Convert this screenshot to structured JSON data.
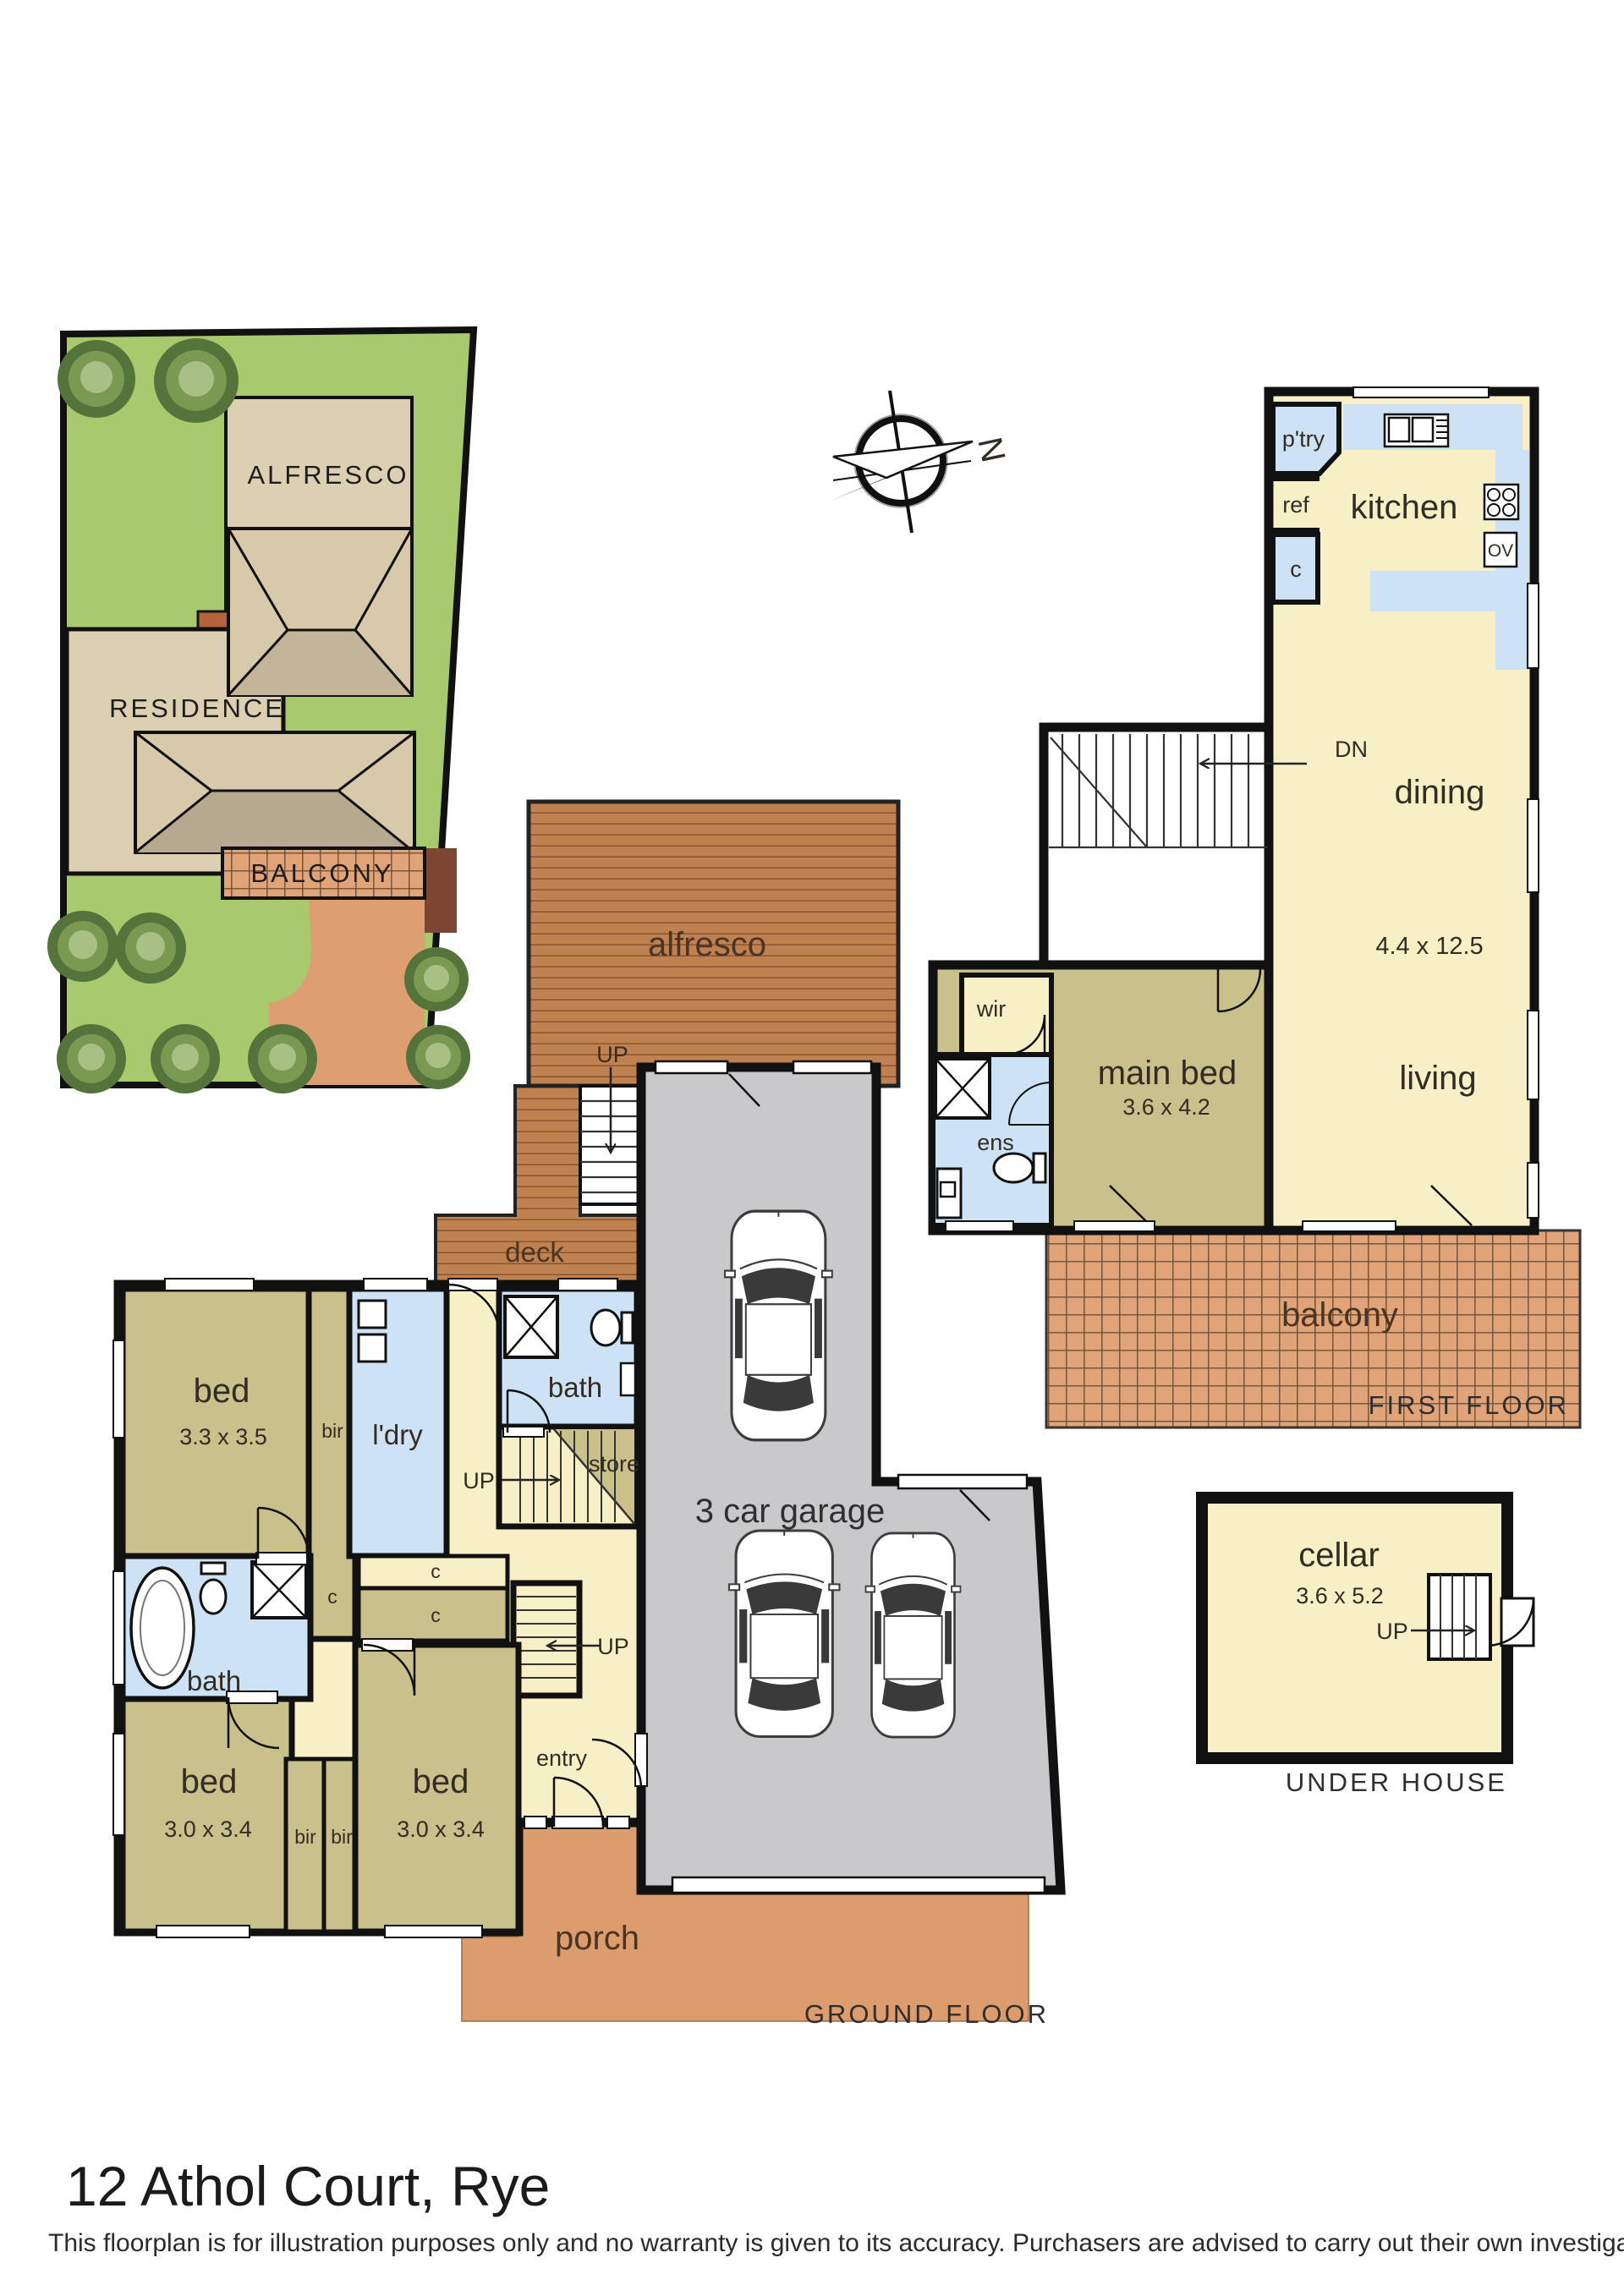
{
  "title": "12 Athol Court, Rye",
  "disclaimer": "This floorplan is for illustration purposes only and no warranty is given to its accuracy. Purchasers are advised to carry out their own investigations.",
  "compass": {
    "north": "N"
  },
  "site": {
    "alfresco": "ALFRESCO",
    "residence": "RESIDENCE",
    "balcony": "BALCONY"
  },
  "first": {
    "pantry": "p'try",
    "ref": "ref",
    "cupboard": "c",
    "kitchen": "kitchen",
    "oven": "OV",
    "dn": "DN",
    "dining": "dining",
    "living_dims": "4.4 x 12.5",
    "living": "living",
    "wir": "wir",
    "ens": "ens",
    "main_bed": "main bed",
    "main_bed_dims": "3.6 x 4.2",
    "balcony": "balcony",
    "caption": "FIRST FLOOR"
  },
  "ground": {
    "alfresco": "alfresco",
    "up_alfresco": "UP",
    "deck": "deck",
    "bed1": "bed",
    "bed1_dims": "3.3 x 3.5",
    "bir1": "bir",
    "laundry": "l'dry",
    "bath1": "bath",
    "store": "store",
    "up_mid": "UP",
    "c1": "c",
    "c2": "c",
    "c3": "c",
    "up_garage": "UP",
    "bath2": "bath",
    "bed2": "bed",
    "bed2_dims": "3.0 x 3.4",
    "bir2": "bir",
    "bir3": "bir",
    "bed3": "bed",
    "bed3_dims": "3.0 x 3.4",
    "entry": "entry",
    "garage": "3 car garage",
    "porch": "porch",
    "caption": "GROUND FLOOR"
  },
  "cellar": {
    "name": "cellar",
    "dims": "3.6 x 5.2",
    "up": "UP",
    "caption": "UNDER HOUSE"
  },
  "colors": {
    "lawn": "#a9ca6c",
    "site_beige": "#ddd0b2",
    "roof_light": "#d8c9ab",
    "roof_dark": "#b7a890",
    "deck_brown": "#bf8150",
    "terracotta": "#e0a478",
    "porch": "#dc9c6d",
    "room_cream": "#f7f0c6",
    "room_olive": "#c9c08c",
    "wet_blue": "#cde2f4",
    "garage_grey": "#c9c9cc",
    "wall": "#111111"
  }
}
